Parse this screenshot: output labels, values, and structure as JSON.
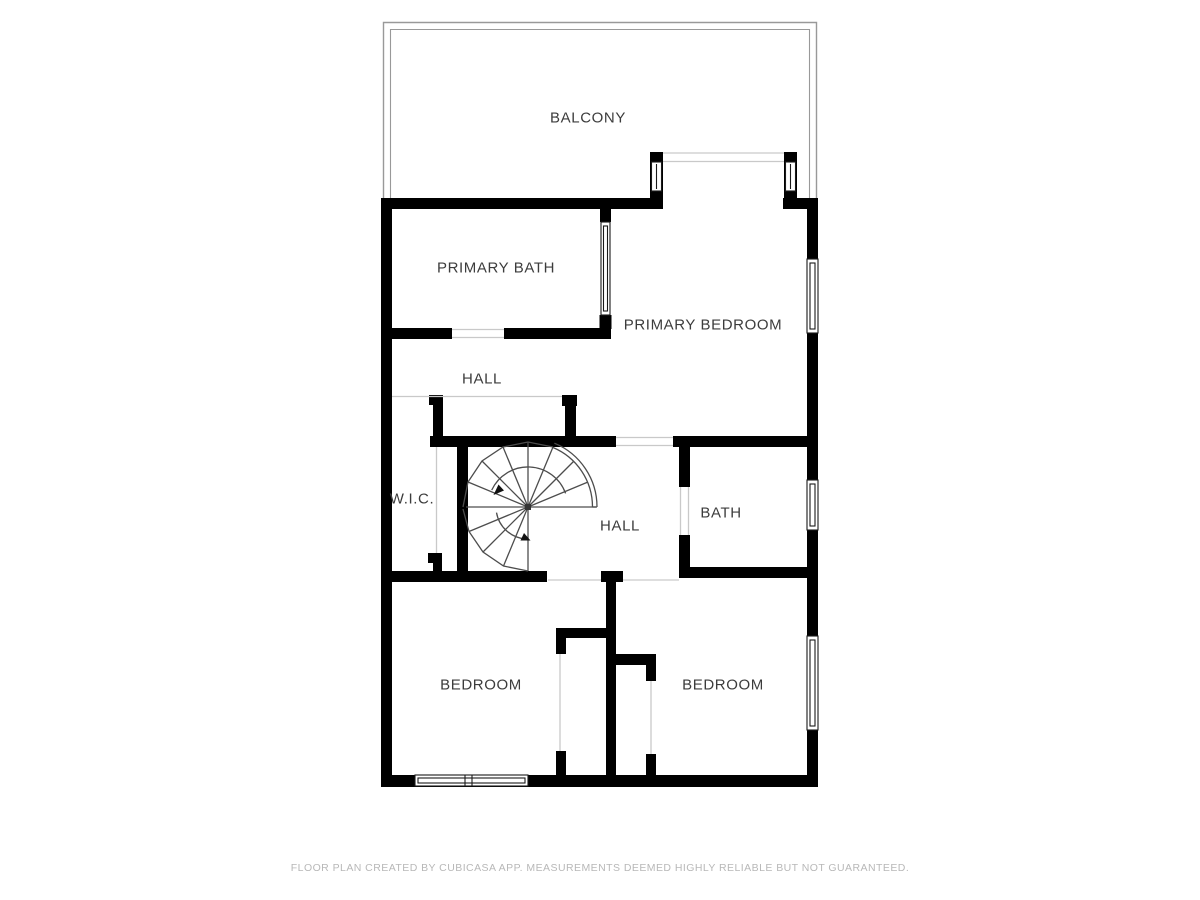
{
  "floor_plan": {
    "rooms": {
      "balcony": {
        "label": "BALCONY"
      },
      "primary_bath": {
        "label": "PRIMARY BATH"
      },
      "primary_bedroom": {
        "label": "PRIMARY BEDROOM"
      },
      "hall_upper": {
        "label": "HALL"
      },
      "wic": {
        "label": "W.I.C."
      },
      "hall_lower": {
        "label": "HALL"
      },
      "bath": {
        "label": "BATH"
      },
      "bedroom_left": {
        "label": "BEDROOM"
      },
      "bedroom_right": {
        "label": "BEDROOM"
      }
    },
    "colors": {
      "wall": "#000000",
      "opening_line": "#c9c9c9",
      "stair_line": "#4d4d4d",
      "balcony_outline": "#999999",
      "label_text": "#3c3c3c",
      "footer_text": "#b8b8b8",
      "background": "#ffffff"
    }
  },
  "footer": {
    "disclaimer": "FLOOR PLAN CREATED BY CUBICASA APP. MEASUREMENTS DEEMED HIGHLY RELIABLE BUT NOT GUARANTEED."
  }
}
